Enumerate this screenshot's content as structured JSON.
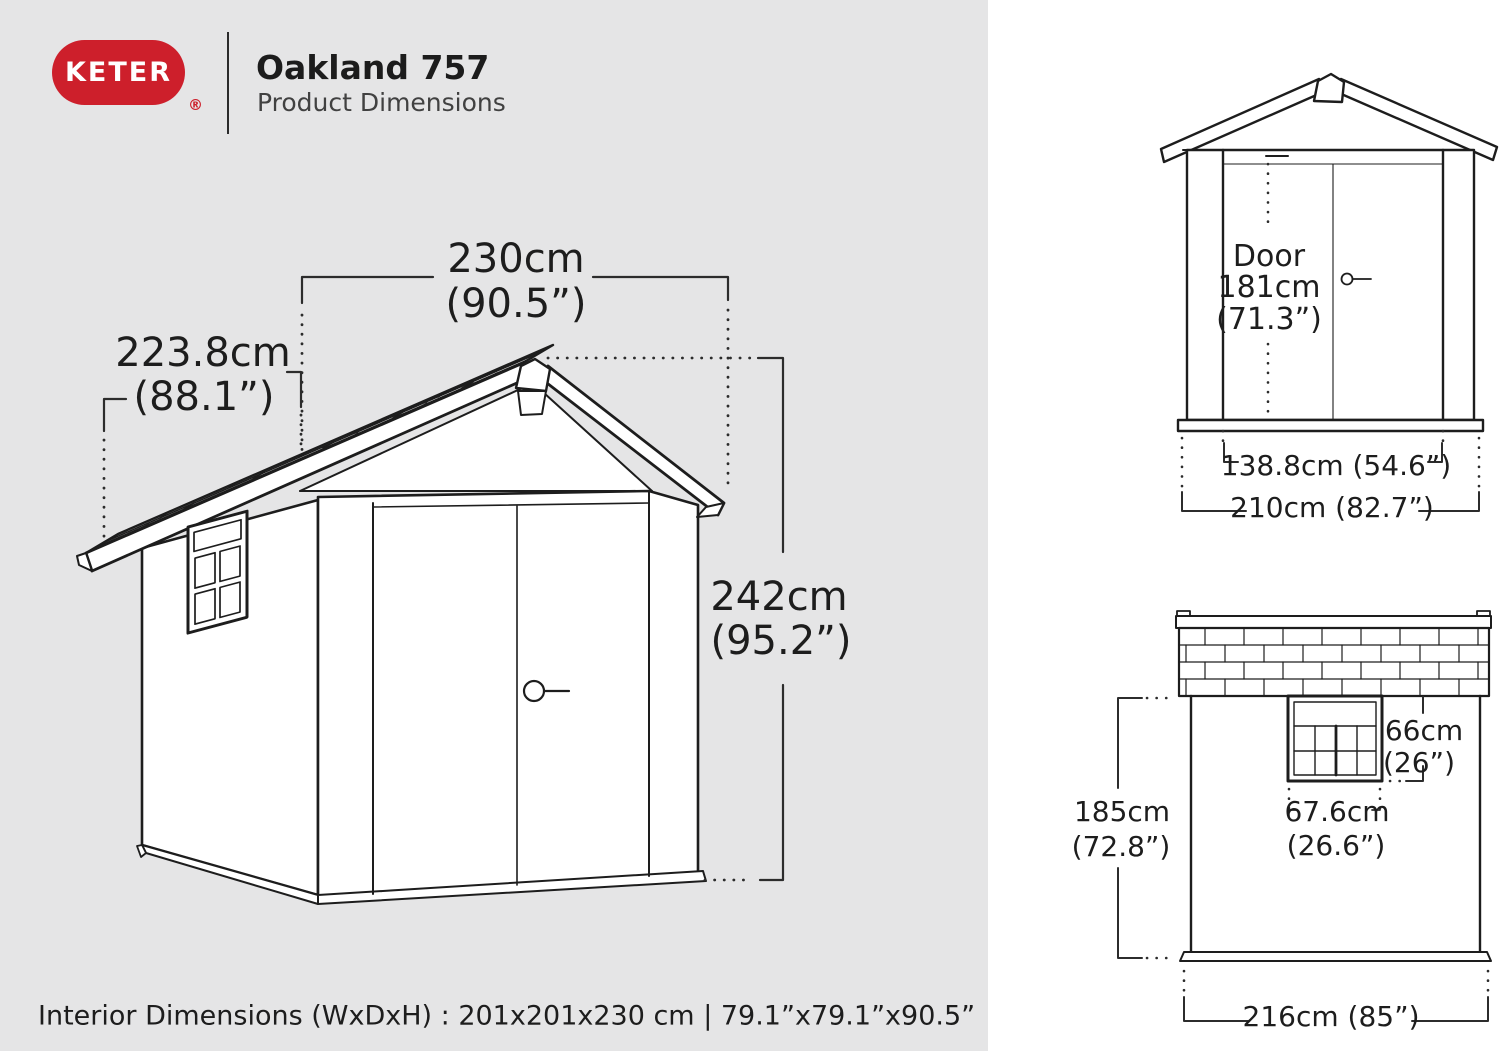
{
  "colors": {
    "panel_gray": "#e5e5e6",
    "panel_white": "#ffffff",
    "ink": "#1d1d1d",
    "dim": "#2c2c2c",
    "brand_red": "#cd1f2b",
    "title_ink": "#1c1c1c",
    "subtitle_ink": "#414141"
  },
  "header": {
    "brand": "KETER",
    "registered": "®",
    "title": "Oakland 757",
    "subtitle": "Product Dimensions"
  },
  "main_view": {
    "width_cm": "230cm",
    "width_in": "(90.5”)",
    "depth_cm": "223.8cm",
    "depth_in": "(88.1”)",
    "height_cm": "242cm",
    "height_in": "(95.2”)"
  },
  "front_view": {
    "door_label": "Door",
    "door_height_cm": "181cm",
    "door_height_in": "(71.3”)",
    "door_opening_width": "138.8cm (54.6”)",
    "overall_width": "210cm (82.7”)"
  },
  "side_view": {
    "window_height_cm": "66cm",
    "window_height_in": "(26”)",
    "window_width_cm": "67.6cm",
    "window_width_in": "(26.6”)",
    "wall_height_cm": "185cm",
    "wall_height_in": "(72.8”)",
    "overall_width": "216cm (85”)"
  },
  "footer": {
    "interior_dimensions": "Interior Dimensions (WxDxH) : 201x201x230 cm | 79.1”x79.1”x90.5”"
  }
}
